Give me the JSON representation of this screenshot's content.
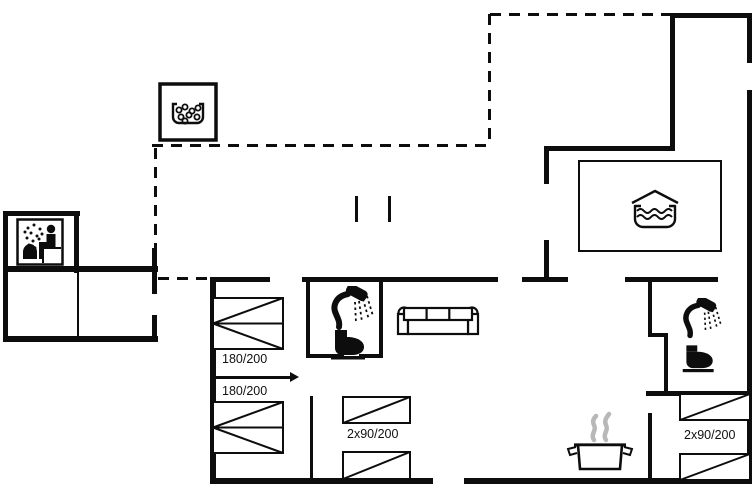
{
  "plan": {
    "kind": "vacation-house-floor-plan",
    "colors": {
      "background": "#ffffff",
      "wall": "#0d0d0d",
      "steam": "#b8b8b8"
    },
    "labels": {
      "bed_double_top": "180/200",
      "bed_double_bottom": "180/200",
      "bunk_middle": "2x90/200",
      "bunk_right": "2x90/200"
    },
    "icons": {
      "whirlpool": "whirlpool-tub-with-bubbles",
      "sauna": "sauna-person-with-steam-and-stove",
      "bathtub": "bathtub-with-water",
      "shower_middle": "shower-head-with-spray",
      "toilet_middle": "toilet-side-view",
      "shower_right": "shower-head-with-spray",
      "toilet_right": "toilet-side-view",
      "sofa": "three-seat-sofa-top-view",
      "stove": "cooking-pot-with-steam"
    }
  }
}
